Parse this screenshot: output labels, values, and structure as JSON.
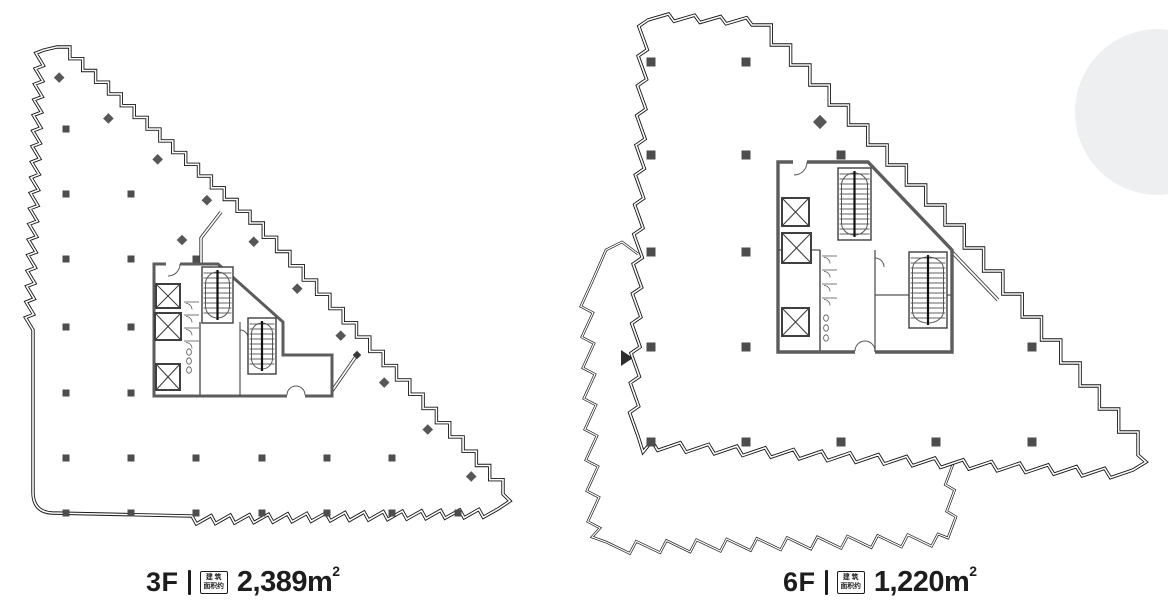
{
  "page": {
    "background": "#ffffff"
  },
  "colors": {
    "wall": "#161616",
    "outer_line": "#1d1d1d",
    "core_wall": "#5c5c5c",
    "detail": "#3f3f3f",
    "thin": "#555555",
    "column": "#4d4d4d",
    "diamond": "#575757",
    "label_text": "#1d1d1d",
    "circle": "#edeff0"
  },
  "plans": [
    {
      "id": "3f",
      "floor_label": "3F",
      "badge_line1": "建 筑",
      "badge_line2": "面积约",
      "area_value": "2,389",
      "area_unit": "m",
      "area_sup": "2"
    },
    {
      "id": "6f",
      "floor_label": "6F",
      "badge_line1": "建 筑",
      "badge_line2": "面积约",
      "area_value": "1,220",
      "area_unit": "m",
      "area_sup": "2"
    }
  ]
}
